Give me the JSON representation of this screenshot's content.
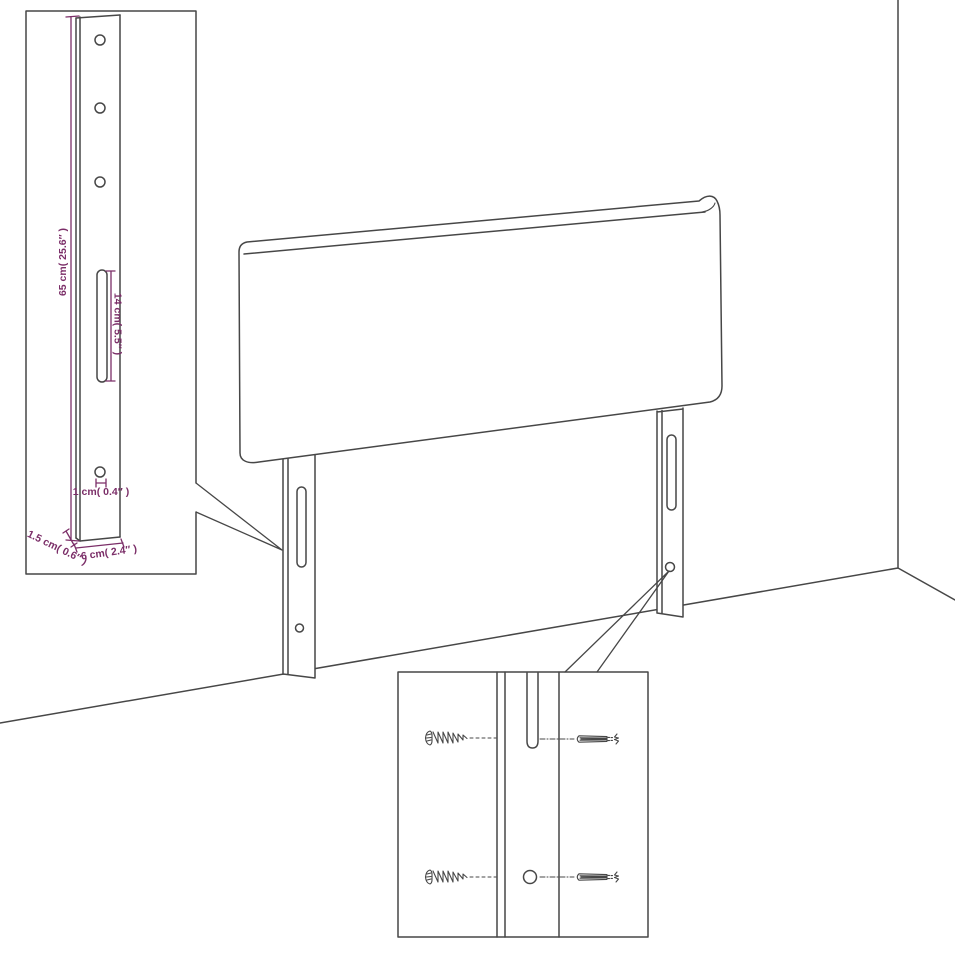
{
  "labels": {
    "leg_height": "65 cm( 25.6″ )",
    "slot_length": "14 cm( 5.5″ )",
    "hole_diameter": "1 cm( 0.4″ )",
    "leg_thickness": "1.5 cm( 0.6″ )",
    "leg_width": "6 cm( 2.4″ )"
  },
  "colors": {
    "line": "#474747",
    "dimension": "#7b2e68",
    "background": "#ffffff"
  }
}
